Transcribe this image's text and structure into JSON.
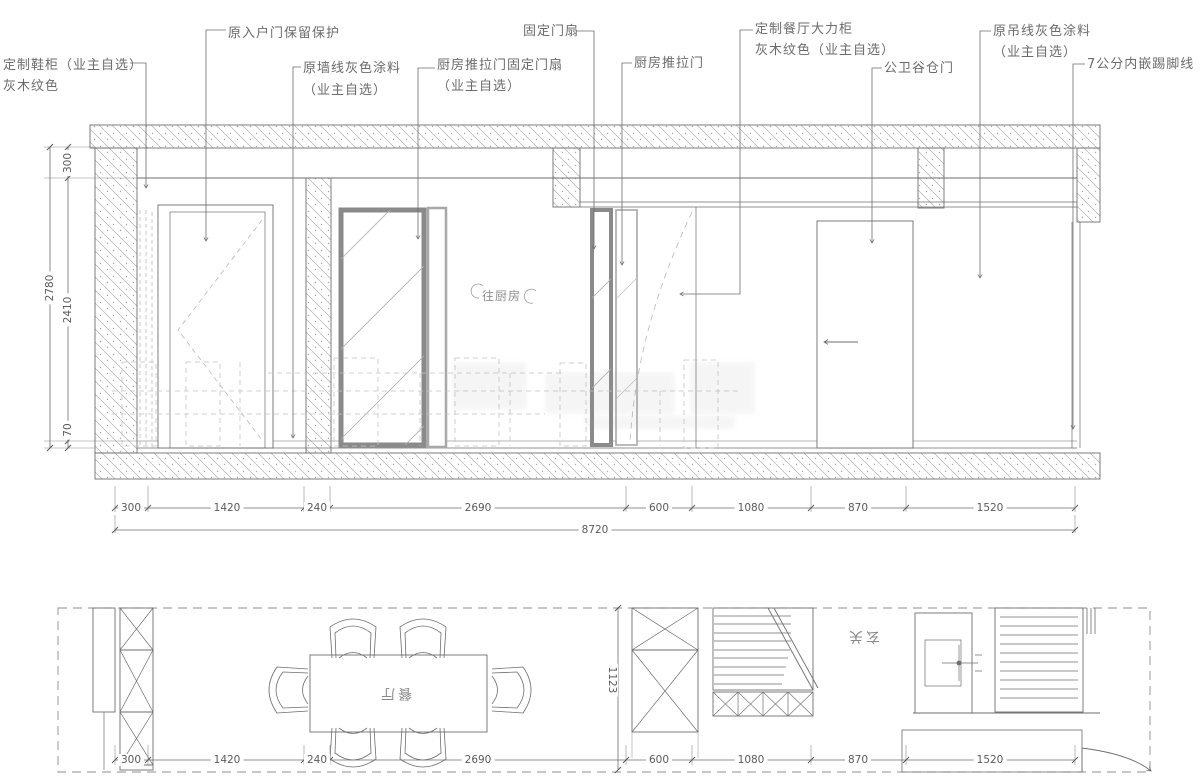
{
  "callouts": [
    {
      "line1": "定制鞋柜（业主自选）",
      "line2": "灰木纹色"
    },
    {
      "line1": "原入户门保留保护"
    },
    {
      "line1": "原墙线灰色涂料",
      "line2": "（业主自选）"
    },
    {
      "line1": "厨房推拉门固定门扇",
      "line2": "（业主自选）"
    },
    {
      "line1": "固定门扇"
    },
    {
      "line1": "厨房推拉门"
    },
    {
      "line1": "定制餐厅大力柜",
      "line2": "灰木纹色（业主自选）"
    },
    {
      "line1": "公卫谷仓门"
    },
    {
      "line1": "原吊线灰色涂料",
      "line2": "（业主自选）"
    },
    {
      "line1": "7公分内嵌踢脚线"
    }
  ],
  "elevation": {
    "kitchen_passage_label": "往厨房",
    "dims_left": {
      "top": "300",
      "middle": "2410",
      "overall": "2780",
      "bottom": "70"
    },
    "dims_bottom": [
      "300",
      "1420",
      "240",
      "2690",
      "600",
      "1080",
      "870",
      "1520"
    ],
    "dim_total": "8720"
  },
  "plan": {
    "dining_label": "餐厅",
    "entry_label": "玄关",
    "dim_depth": "1123",
    "dims_bottom": [
      "300",
      "1420",
      "240",
      "2690",
      "600",
      "1080",
      "870",
      "1520"
    ]
  },
  "colors": {
    "line": "#6e6e6e",
    "dim": "#5a5a5a",
    "frame": "#8a8a8a",
    "hatch": "#adadad"
  }
}
